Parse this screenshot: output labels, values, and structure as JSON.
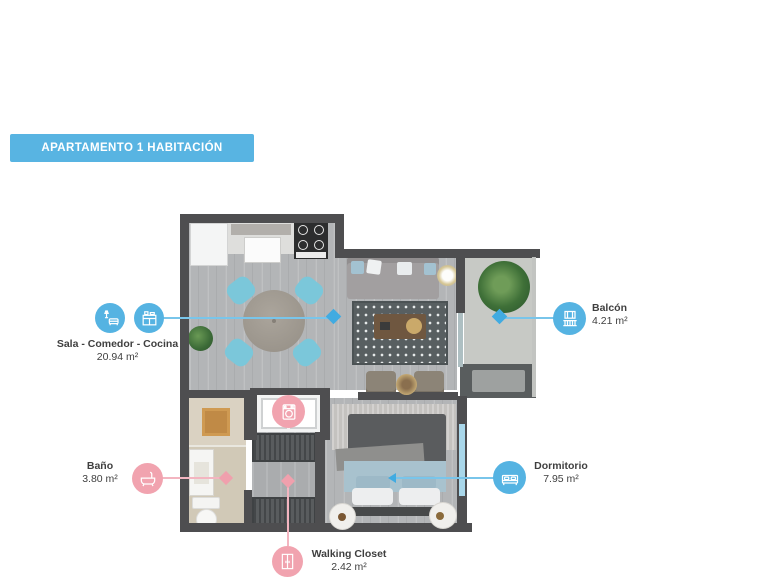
{
  "banner": {
    "title": "APARTAMENTO 1 HABITACIÓN"
  },
  "labels": {
    "sala": {
      "name": "Sala - Comedor - Cocina",
      "area": "20.94 m²"
    },
    "balcon": {
      "name": "Balcón",
      "area": "4.21 m²"
    },
    "bano": {
      "name": "Baño",
      "area": "3.80 m²"
    },
    "dormitorio": {
      "name": "Dormitorio",
      "area": "7.95 m²"
    },
    "walking_closet": {
      "name": "Walking Closet",
      "area": "2.42 m²"
    }
  },
  "icons": {
    "sala": [
      "sofa-lamp-icon",
      "kitchen-cabinet-icon"
    ],
    "balcon": "balcony-railing-icon",
    "bano": "bathtub-icon",
    "dormitorio": "bed-icon",
    "walking_closet": "wardrobe-icon",
    "laundry": "washing-machine-icon"
  },
  "palette": {
    "banner_bg": "#58b4e2",
    "accent_blue": "#55b3e2",
    "accent_blue_line": "#79c5ea",
    "accent_pink": "#f1a3af",
    "accent_pink_line": "#f3b5c0",
    "label_text": "#3f3f3f",
    "wall": "#4e4e50"
  }
}
